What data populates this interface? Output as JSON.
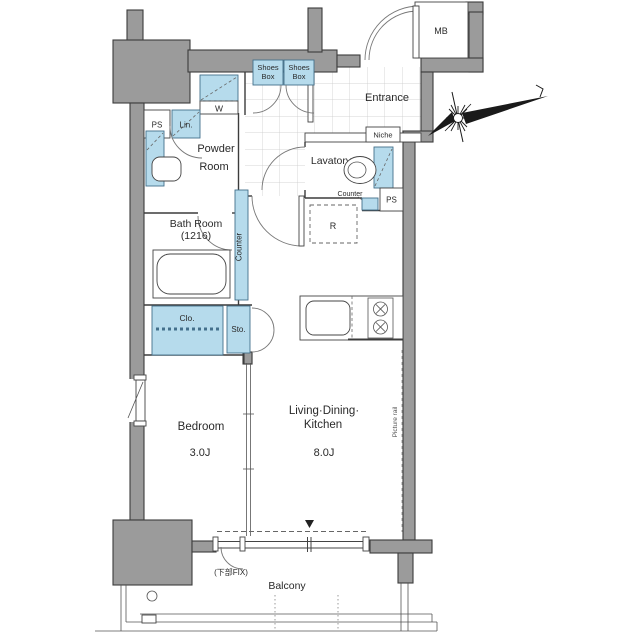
{
  "floor_plan": {
    "colors": {
      "wall_gray": "#9b9b9b",
      "fixture_blue": "#b6dbec",
      "outline_dark": "#3c3c3c"
    },
    "rooms": {
      "mb": {
        "label": "MB"
      },
      "entrance": {
        "label": "Entrance"
      },
      "powder_room": {
        "line1": "Powder",
        "line2": "Room"
      },
      "lavatory": {
        "label": "Lavatory"
      },
      "bath_room": {
        "line1": "Bath Room",
        "line2": "(1216)"
      },
      "bedroom": {
        "label": "Bedroom",
        "area": "3.0J"
      },
      "ldk": {
        "line1": "Living·Dining·",
        "line2": "Kitchen",
        "area": "8.0J"
      },
      "balcony": {
        "label": "Balcony"
      }
    },
    "fixtures": {
      "shoes_box": {
        "line1": "Shoes",
        "line2": "Box"
      },
      "w_closet": "W",
      "ps_left": "PS",
      "linen": "Lin.",
      "niche": "Niche",
      "counter_lavatory": "Counter",
      "ps_right": "PS",
      "refrigerator": "R",
      "closet": "Clo.",
      "storage": "Sto.",
      "kitchen_counter": "Counter",
      "picture_rail": "Picture rail",
      "lower_fix_window": "(下部FIX)"
    }
  }
}
